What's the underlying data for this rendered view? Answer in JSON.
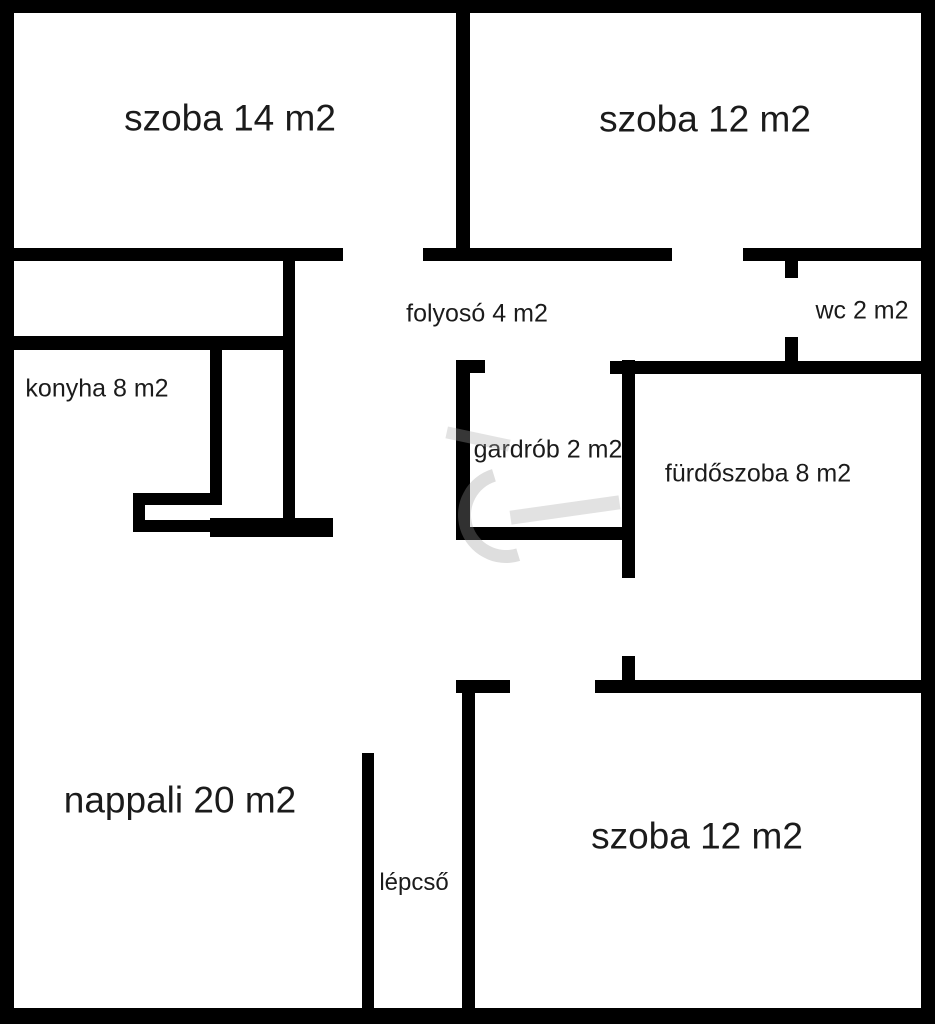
{
  "canvas": {
    "width": 935,
    "height": 1024,
    "background": "#ffffff",
    "wall_color": "#000000",
    "label_color": "#1b1b1b",
    "watermark_color": "#a0a0a0"
  },
  "rooms": [
    {
      "id": "szoba-14",
      "label": "szoba 14 m2",
      "cx": 230,
      "cy": 118,
      "font_px": 37
    },
    {
      "id": "szoba-12-top",
      "label": "szoba 12 m2",
      "cx": 705,
      "cy": 119,
      "font_px": 37
    },
    {
      "id": "folyoso",
      "label": "folyosó 4 m2",
      "cx": 477,
      "cy": 314,
      "font_px": 25
    },
    {
      "id": "wc",
      "label": "wc 2 m2",
      "cx": 862,
      "cy": 311,
      "font_px": 25
    },
    {
      "id": "konyha",
      "label": "konyha 8 m2",
      "cx": 97,
      "cy": 389,
      "font_px": 25
    },
    {
      "id": "gardrob",
      "label": "gardrób 2 m2",
      "cx": 548,
      "cy": 450,
      "font_px": 25
    },
    {
      "id": "furdoszoba",
      "label": "fürdőszoba 8 m2",
      "cx": 758,
      "cy": 474,
      "font_px": 25
    },
    {
      "id": "nappali",
      "label": "nappali 20 m2",
      "cx": 180,
      "cy": 800,
      "font_px": 37
    },
    {
      "id": "lepcso",
      "label": "lépcső",
      "cx": 414,
      "cy": 883,
      "font_px": 24
    },
    {
      "id": "szoba-12-bottom",
      "label": "szoba 12 m2",
      "cx": 697,
      "cy": 836,
      "font_px": 37
    }
  ],
  "walls": [
    {
      "name": "outer-top",
      "x": 0,
      "y": 0,
      "w": 935,
      "h": 13
    },
    {
      "name": "outer-left",
      "x": 0,
      "y": 0,
      "w": 14,
      "h": 1024
    },
    {
      "name": "outer-bottom",
      "x": 0,
      "y": 1008,
      "w": 935,
      "h": 16
    },
    {
      "name": "outer-right",
      "x": 921,
      "y": 0,
      "w": 14,
      "h": 1024
    },
    {
      "name": "szoba14-szoba12-divider",
      "x": 456,
      "y": 0,
      "w": 14,
      "h": 261
    },
    {
      "name": "szoba14-bottom",
      "x": 0,
      "y": 248,
      "w": 343,
      "h": 13
    },
    {
      "name": "szoba12top-bottom-left",
      "x": 423,
      "y": 248,
      "w": 249,
      "h": 13
    },
    {
      "name": "szoba12top-bottom-right",
      "x": 743,
      "y": 248,
      "w": 192,
      "h": 13
    },
    {
      "name": "wc-left-upper-stub",
      "x": 785,
      "y": 261,
      "w": 13,
      "h": 17
    },
    {
      "name": "wc-left-lower-stub",
      "x": 785,
      "y": 337,
      "w": 13,
      "h": 26
    },
    {
      "name": "furdoszoba-top",
      "x": 610,
      "y": 361,
      "w": 325,
      "h": 13
    },
    {
      "name": "gardrob-top-cap",
      "x": 456,
      "y": 360,
      "w": 29,
      "h": 13
    },
    {
      "name": "gardrob-left",
      "x": 456,
      "y": 360,
      "w": 14,
      "h": 180
    },
    {
      "name": "gardrob-bottom",
      "x": 456,
      "y": 527,
      "w": 179,
      "h": 13
    },
    {
      "name": "gardrob-right",
      "x": 622,
      "y": 360,
      "w": 13,
      "h": 218
    },
    {
      "name": "furdoszoba-door-stub",
      "x": 622,
      "y": 656,
      "w": 13,
      "h": 37
    },
    {
      "name": "szoba12bottom-top-right",
      "x": 595,
      "y": 680,
      "w": 340,
      "h": 13
    },
    {
      "name": "szoba12bottom-top-stub",
      "x": 456,
      "y": 680,
      "w": 54,
      "h": 13
    },
    {
      "name": "szoba12bottom-left",
      "x": 462,
      "y": 680,
      "w": 13,
      "h": 344
    },
    {
      "name": "konyha-top",
      "x": 13,
      "y": 336,
      "w": 270,
      "h": 14
    },
    {
      "name": "eloszoba-niche-right",
      "x": 283,
      "y": 258,
      "w": 12,
      "h": 262
    },
    {
      "name": "konyha-strip-left",
      "x": 210,
      "y": 343,
      "w": 12,
      "h": 162
    },
    {
      "name": "konyha-niche-top",
      "x": 133,
      "y": 493,
      "w": 89,
      "h": 12
    },
    {
      "name": "konyha-niche-left",
      "x": 133,
      "y": 493,
      "w": 12,
      "h": 39
    },
    {
      "name": "konyha-niche-bottom",
      "x": 133,
      "y": 520,
      "w": 77,
      "h": 12
    },
    {
      "name": "konyha-thick-bottom",
      "x": 210,
      "y": 518,
      "w": 123,
      "h": 19
    },
    {
      "name": "lepcso-left",
      "x": 362,
      "y": 753,
      "w": 12,
      "h": 255
    }
  ]
}
